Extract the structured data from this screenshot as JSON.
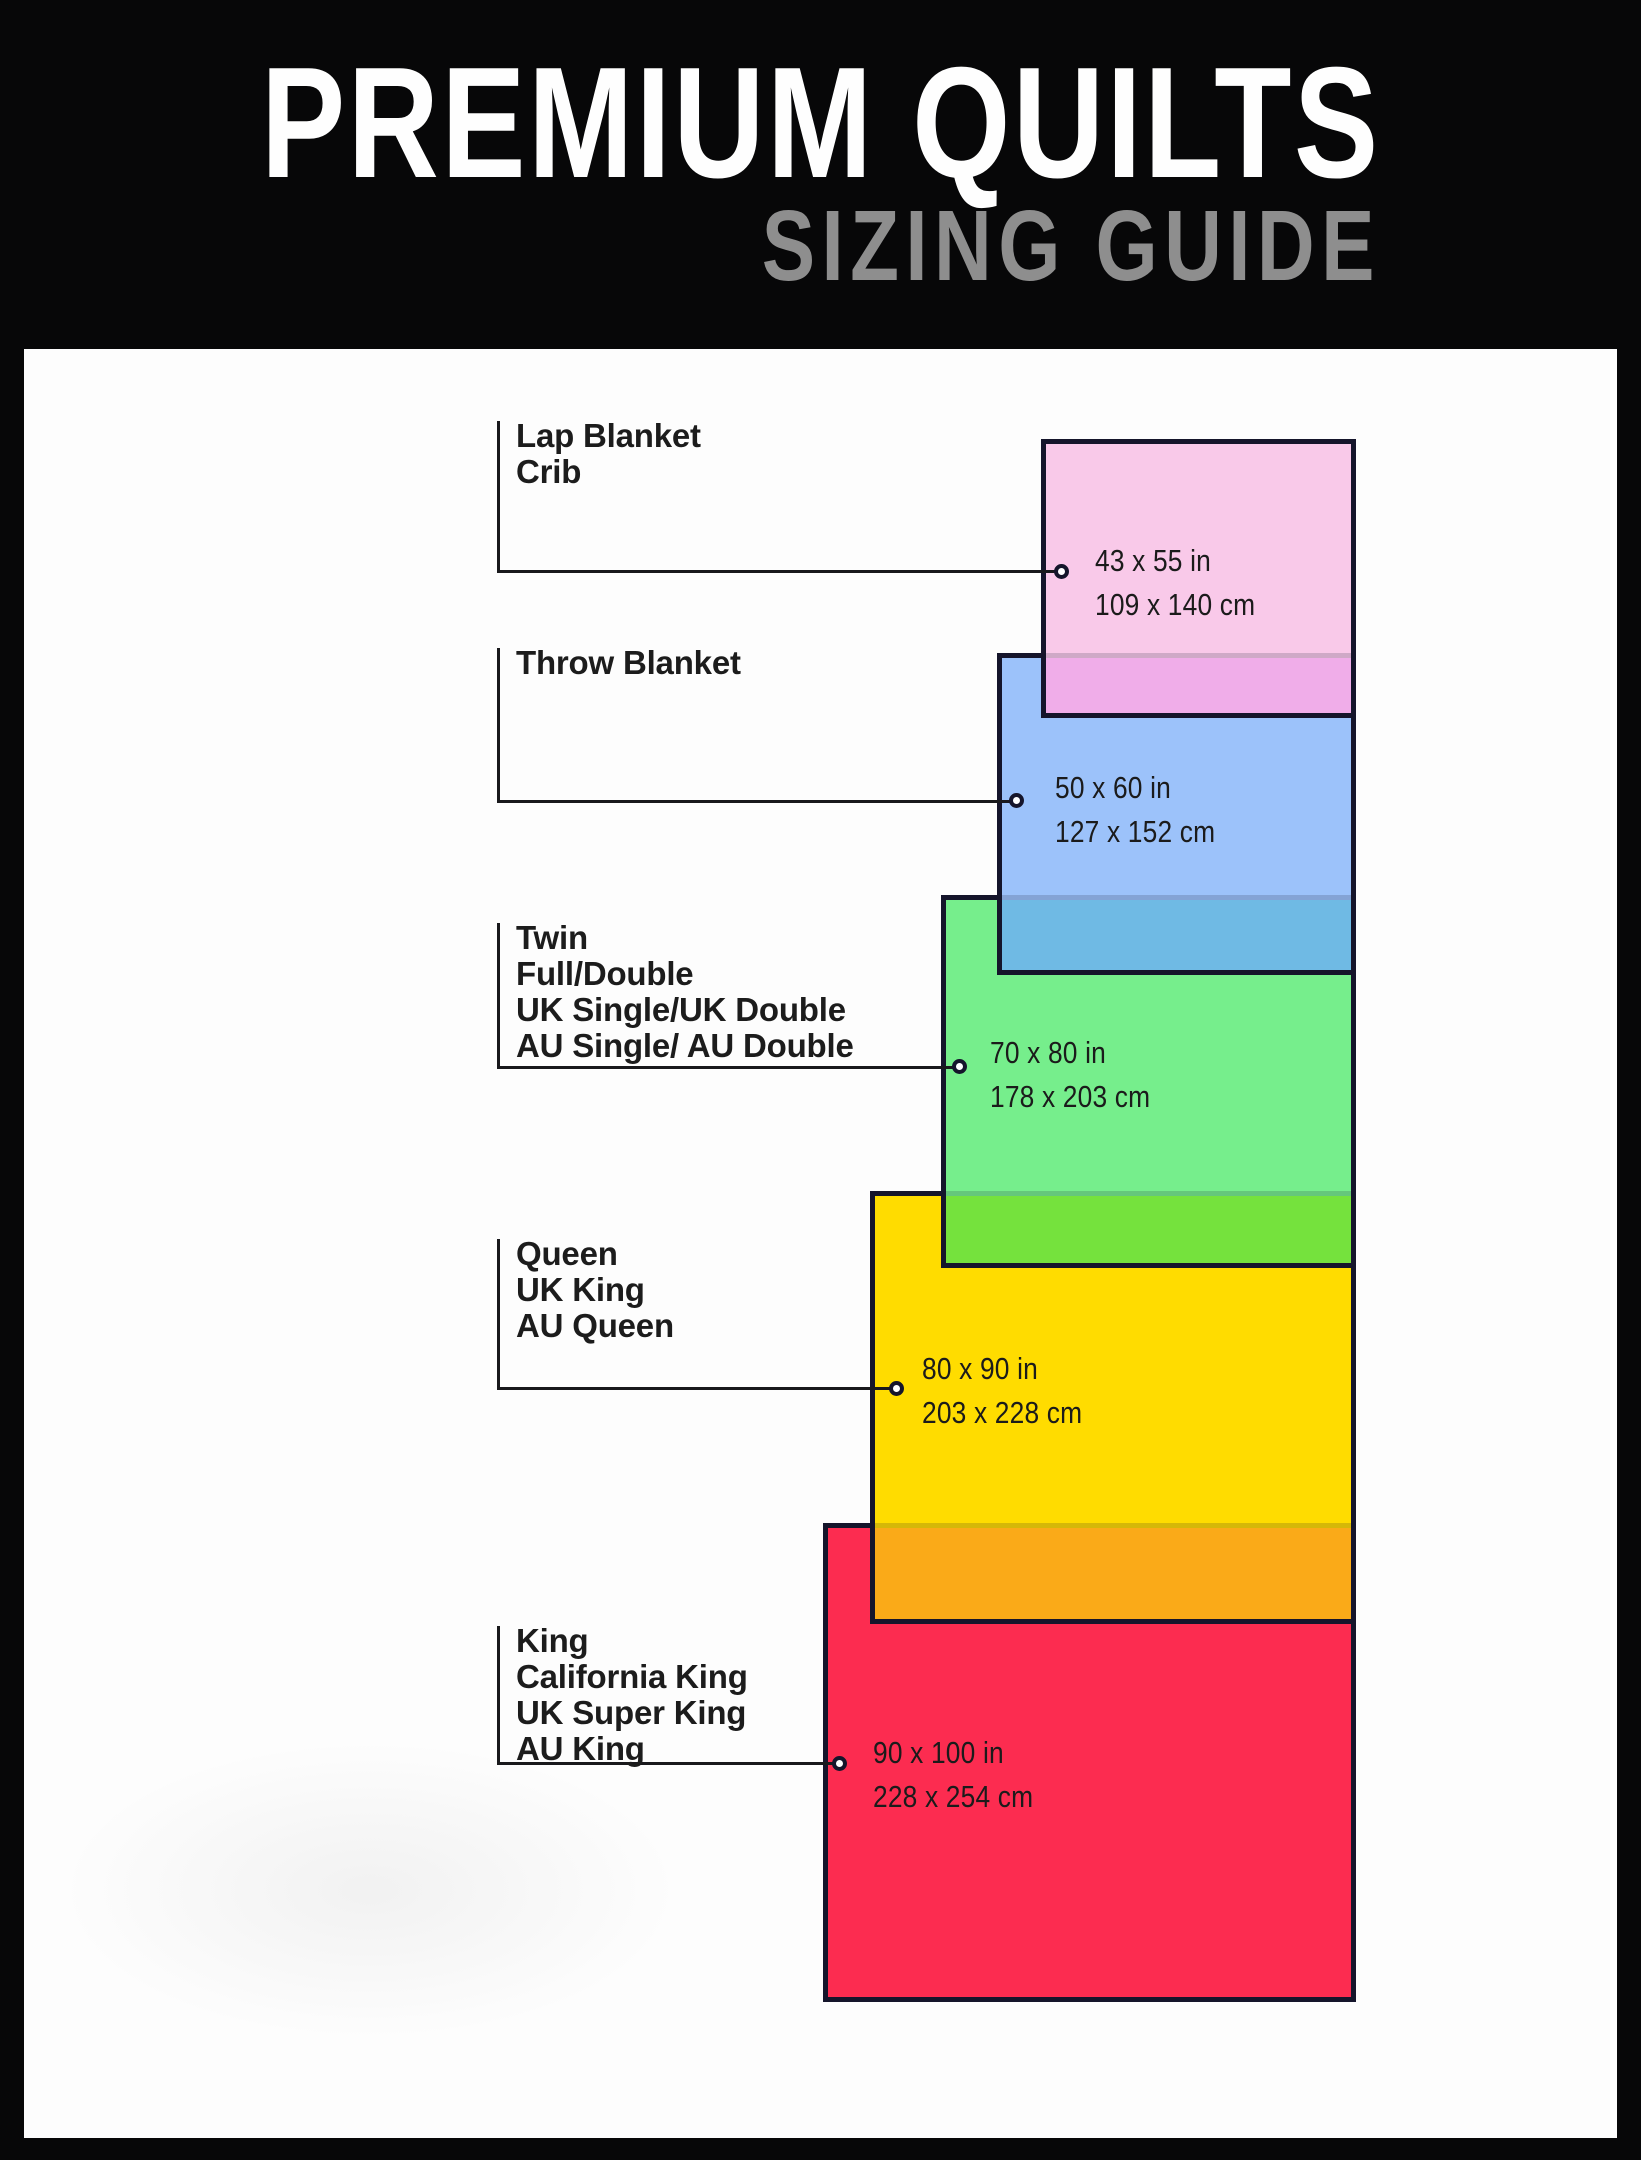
{
  "header": {
    "title": "PREMIUM QUILTS",
    "subtitle": "SIZING GUIDE"
  },
  "sizes": [
    {
      "key": "lap-blanket-crib",
      "labels": [
        "Lap Blanket",
        "Crib"
      ],
      "size_in": "43 x 55 in",
      "size_cm": "109 x 140 cm",
      "fill": "#F9C9E9",
      "overlap_fill": "#F0ADE9",
      "overlap_edge": "#CFA9C7"
    },
    {
      "key": "throw-blanket",
      "labels": [
        "Throw Blanket"
      ],
      "size_in": "50 x 60 in",
      "size_cm": "127 x 152 cm",
      "fill": "#9CC2FA",
      "overlap_fill": "#6FBAE4",
      "overlap_edge": "#84A3D5"
    },
    {
      "key": "twin-full-double",
      "labels": [
        "Twin",
        "Full/Double",
        "UK Single/UK Double",
        "AU Single/ AU Double"
      ],
      "size_in": "70 x 80 in",
      "size_cm": "178 x 203 cm",
      "fill": "#76EE8C",
      "overlap_fill": "#75E23D",
      "overlap_edge": "#65C77B"
    },
    {
      "key": "queen-uk-king-au-queen",
      "labels": [
        "Queen",
        "UK King",
        "AU Queen"
      ],
      "size_in": "80 x 90 in",
      "size_cm": "203 x 228 cm",
      "fill": "#FFDC00",
      "overlap_fill": "#FAAA18",
      "overlap_edge": "#D5B808"
    },
    {
      "key": "king-california-king",
      "labels": [
        "King",
        "California King",
        "UK Super King",
        "AU King"
      ],
      "size_in": "90 x 100 in",
      "size_cm": "228 x 254 cm",
      "fill": "#FC2C50",
      "overlap_fill": null,
      "overlap_edge": null
    }
  ],
  "style": {
    "frame_color": "#070708",
    "panel_color": "#FDFDFD",
    "rect_border_color": "#15152B",
    "connector_color": "#19191C",
    "title_color": "#FEFEFE",
    "subtitle_color": "#8E8E8E",
    "label_color": "#1C1C1C"
  }
}
